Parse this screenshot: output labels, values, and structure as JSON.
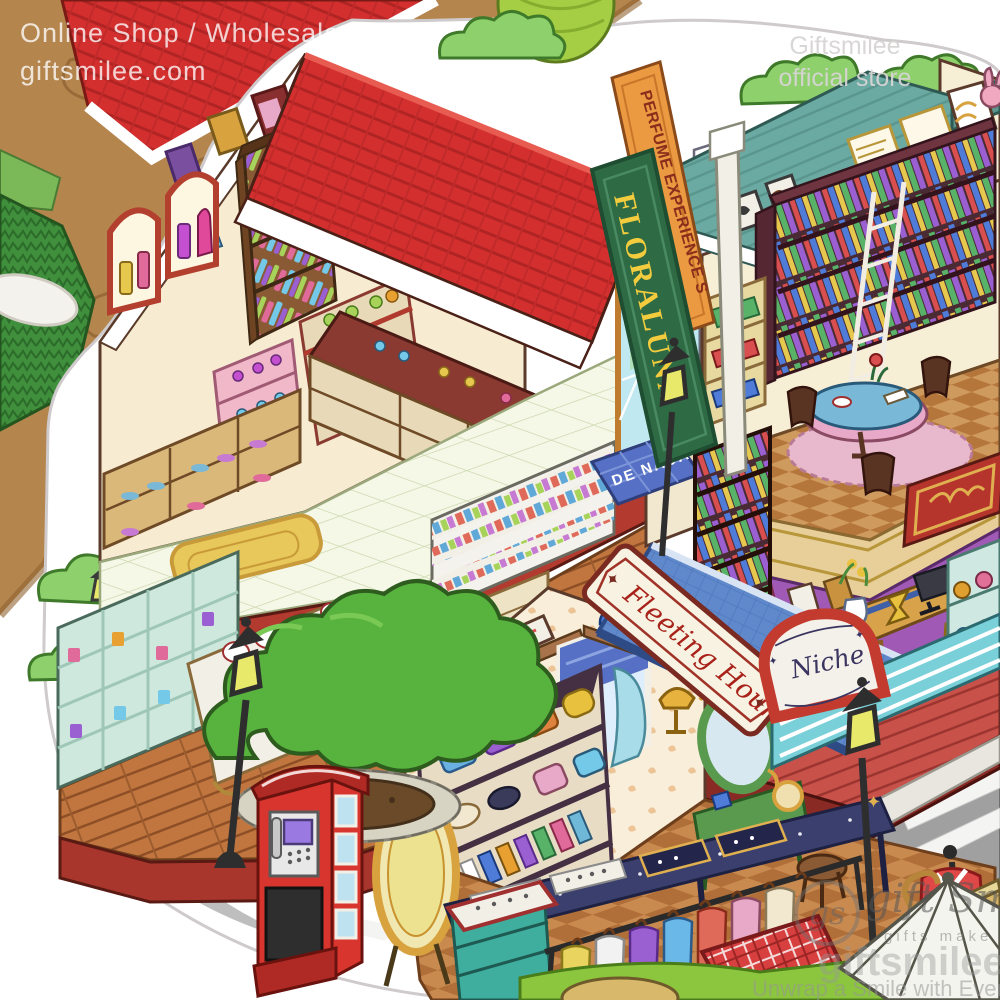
{
  "watermarks": {
    "top_left_line1": "Online Shop / Wholesale",
    "top_left_line2": "giftsmilee.com",
    "top_right_line1": "Giftsmilee",
    "top_right_line2": "official store",
    "logo_monogram": "gs",
    "logo_name": "gift Smilee",
    "logo_tagline": "gifts make smile",
    "logo_site": "giftsmilee.com",
    "logo_slogan": "Unwrap a Smile with Every Gift"
  },
  "signs": {
    "perfume_banner": "PERFUME EXPERIENCE S",
    "flower_shop": "FLORALUNA",
    "doormat": "DE NADA",
    "boutique": "Fleeting Hours",
    "niche": "Niche"
  },
  "palette": {
    "roof_red": "#d32f2f",
    "roof_teal": "#6aaaa2",
    "wall_cream": "#f7ecd2",
    "banner_orange": "#ec9a41",
    "sign_green": "#2e6b45",
    "sign_text_yellow": "#f3cc3e",
    "awning_blue": "#6089cc",
    "mat_blue": "#5570c4",
    "street_gray": "#a0a0a0",
    "booth_red": "#d8352f",
    "tree_green": "#57b33e",
    "floor_wood": "#c1763f"
  }
}
